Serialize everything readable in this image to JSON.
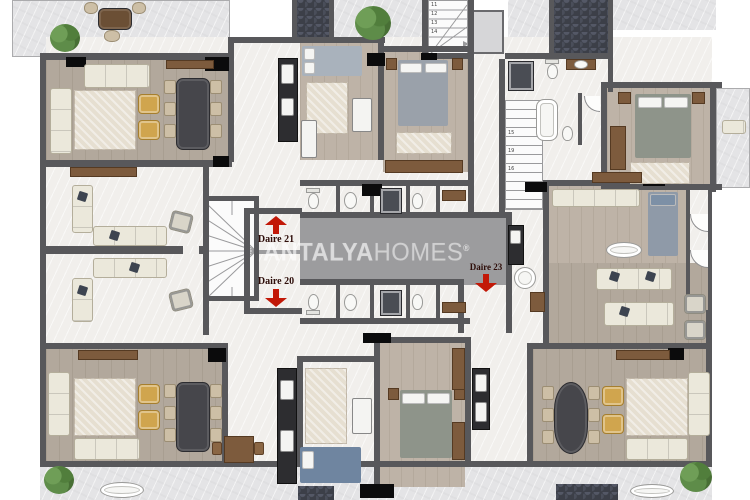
{
  "watermark": {
    "brand_bold": "ANTALYA",
    "brand_light": "HOMES",
    "registered": "®"
  },
  "units": [
    {
      "label": "Daire 21",
      "arrow": "up"
    },
    {
      "label": "Daire 20",
      "arrow": "down"
    },
    {
      "label": "Daire 23",
      "arrow": "down"
    }
  ],
  "stairs_top": {
    "numbers": [
      "11",
      "12",
      "13",
      "14",
      "16"
    ]
  },
  "stairs_right": {
    "numbers": [
      "15",
      "19",
      "16"
    ]
  },
  "colors": {
    "accent-red": "#c21807",
    "wall": "#58585b",
    "corridor": "#9c9c9e",
    "wood-floor": "#b2a89c",
    "marble-ext": "#e4e4e6",
    "marble-int": "#f1efec",
    "cream": "#ebe8db",
    "yellow-chair": "#d0a54e",
    "dark-table": "#46464b",
    "wood-furniture": "#7d5b3d",
    "rug": "#e6dfd1",
    "tile-dark": "#3c3f48"
  }
}
